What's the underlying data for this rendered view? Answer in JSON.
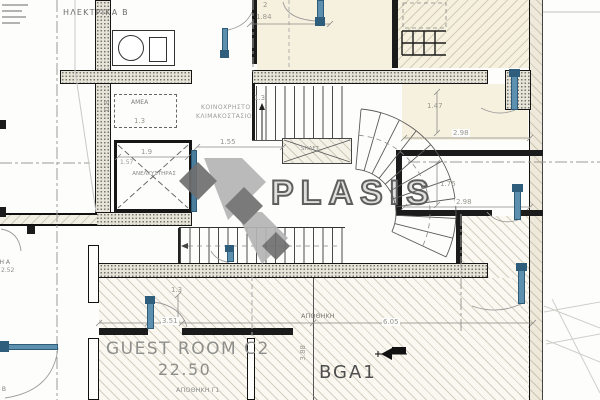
{
  "drawing": {
    "type": "architectural floor plan (basement / storage level)",
    "labels": {
      "electrical_room": "ΗΛΕΚΤΡΙΚΑ Β",
      "amea": "ΑΜΕΑ",
      "common_stair_line1": "ΚΟΙΝΟΧΡΗΣΤΟ",
      "common_stair_line2": "ΚΛΙΜΑΚΟΣΤΑΣΙΟ",
      "elevator": "ΑΝΕΛΚΥΣΤΗΡΑΣ",
      "shaft": "SHAFT",
      "guest_room": "GUEST ROOM C2",
      "guest_room_area": "22.50",
      "storage_g1": "ΑΠΟΘΗΚΗ Γ1",
      "storage_main": "ΑΠΟΘΗΚΗ",
      "storage_code": "BGA1",
      "storage_a": "ΑΠΟΘΗΚΗ Α",
      "storage_a_area": "2.52",
      "storage_b": "ΑΠΟΘΗΚΗ Β"
    },
    "dimensions": {
      "stair_landing": "1.55",
      "stair_flight": "1.3",
      "top_room_width": "1.84",
      "top_room_door": "2",
      "amea_width": "0.8",
      "amea_length": "1.3",
      "elevator_width": "1.9",
      "elevator_depth": "1.57",
      "room_b_width": "1.47",
      "room_b_span": "2.98",
      "room_c_height": "1.76",
      "room_c_span": "2.98",
      "guest_door_offset": "1.3",
      "guest_wall_span": "3.51",
      "storage_span": "6.05",
      "storage_depth": "3.88"
    },
    "watermark": {
      "text": "PLASIS",
      "light_gray": "#b5b5b5",
      "dark_gray": "#6f6f6f"
    },
    "colors": {
      "door_blue": "#4a7d9b",
      "wall_fill": "#e6e3d9",
      "floor_cream": "#f6f1de"
    }
  }
}
